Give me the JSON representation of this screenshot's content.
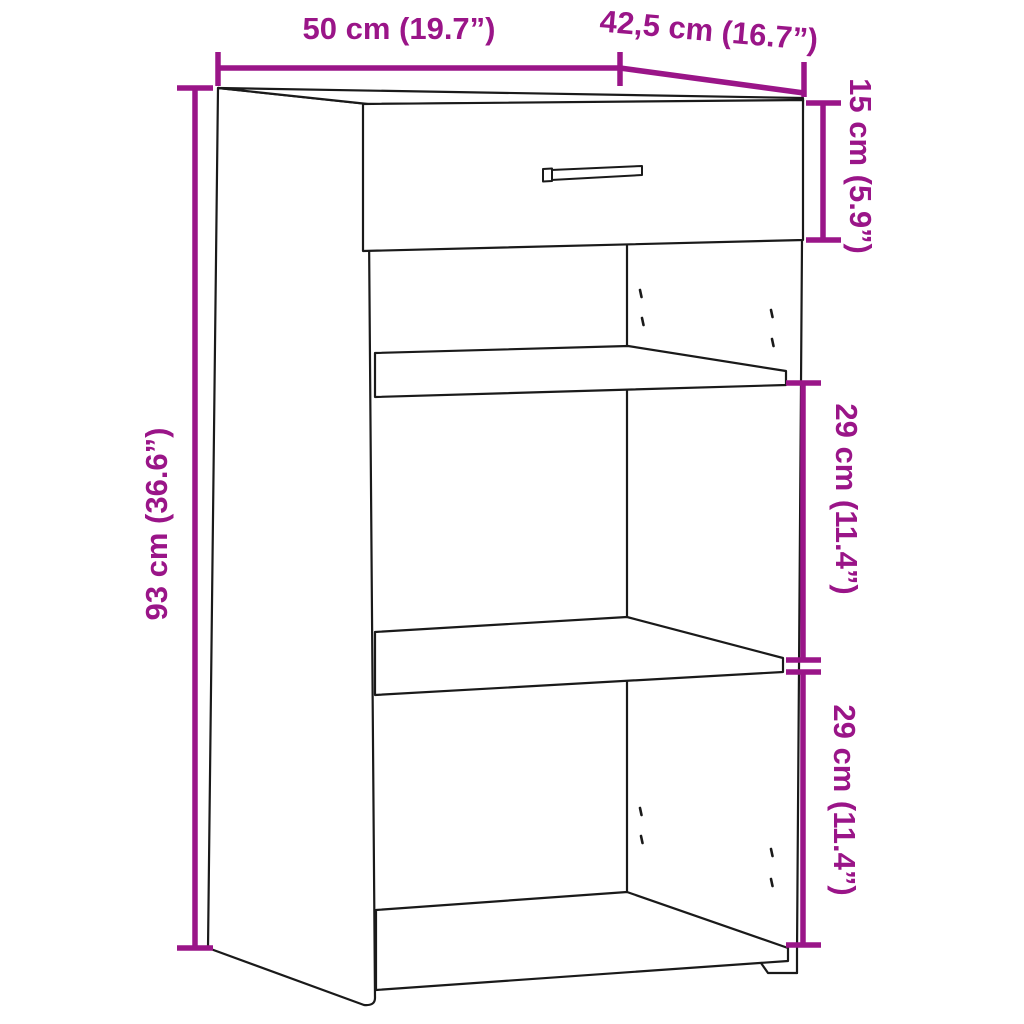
{
  "figure": {
    "subject": "sideboard-with-drawer-and-two-shelves",
    "background_color": "#FFFFFF",
    "outline_color": "#1A1A1A",
    "dimension_color": "#9A1588",
    "dimensions": {
      "width": {
        "label": "50 cm (19.7”)",
        "value_cm": "50",
        "value_in": "19.7"
      },
      "depth": {
        "label": "42,5 cm (16.7”)",
        "value_cm": "42,5",
        "value_in": "16.7"
      },
      "height": {
        "label": "93 cm (36.6”)",
        "value_cm": "93",
        "value_in": "36.6"
      },
      "drawer_front_height": {
        "label": "15 cm (5.9”)",
        "value_cm": "15",
        "value_in": "5.9"
      },
      "upper_compartment_height": {
        "label": "29 cm (11.4”)",
        "value_cm": "29",
        "value_in": "11.4"
      },
      "lower_compartment_height": {
        "label": "29 cm (11.4”)",
        "value_cm": "29",
        "value_in": "11.4"
      }
    }
  }
}
